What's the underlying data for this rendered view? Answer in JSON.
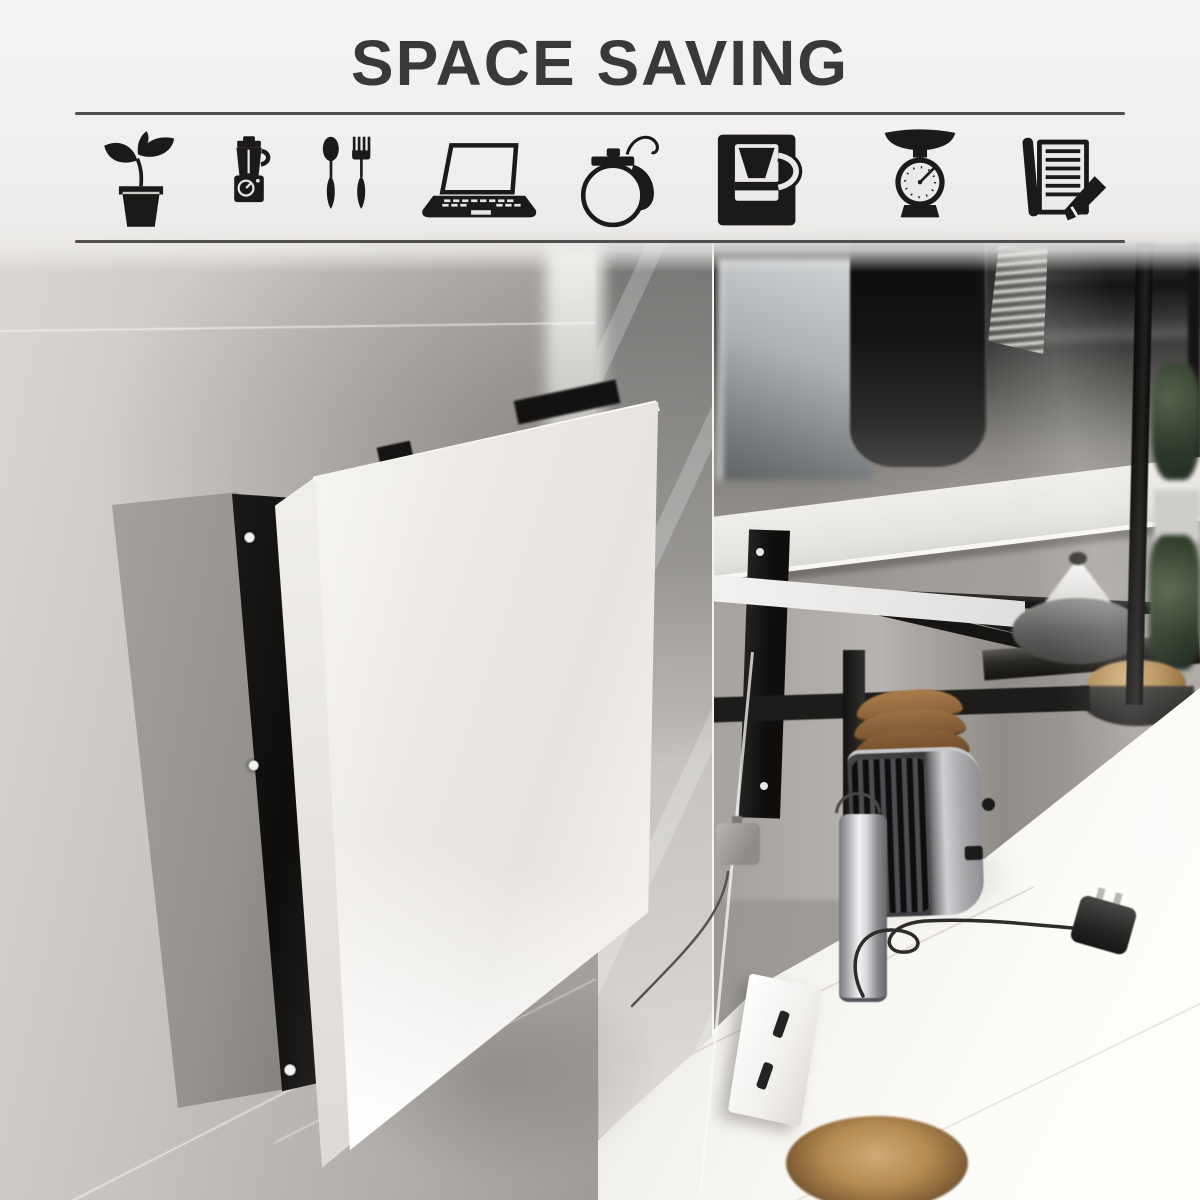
{
  "header": {
    "title": "SPACE SAVING"
  },
  "icon_strip": {
    "items": [
      {
        "icon": "potted-plant-icon"
      },
      {
        "icon": "blender-icon"
      },
      {
        "icon": "cutlery-icon"
      },
      {
        "icon": "laptop-icon"
      },
      {
        "icon": "teapot-icon"
      },
      {
        "icon": "coffee-maker-icon"
      },
      {
        "icon": "kitchen-scale-icon"
      },
      {
        "icon": "notepad-pencil-icon"
      }
    ]
  },
  "palette": {
    "ink": "#1c1a19",
    "title_color": "#3a3938",
    "divider_color": "#514f4d",
    "wall_light": "#dcd9d6",
    "wall_mid": "#a39f9b",
    "table_panel_white": "#f3f0ec",
    "bracket_black": "#171615",
    "counter_white": "#faf8f5",
    "bread_brown": "#8a6138",
    "greenery_green": "#32402e"
  }
}
